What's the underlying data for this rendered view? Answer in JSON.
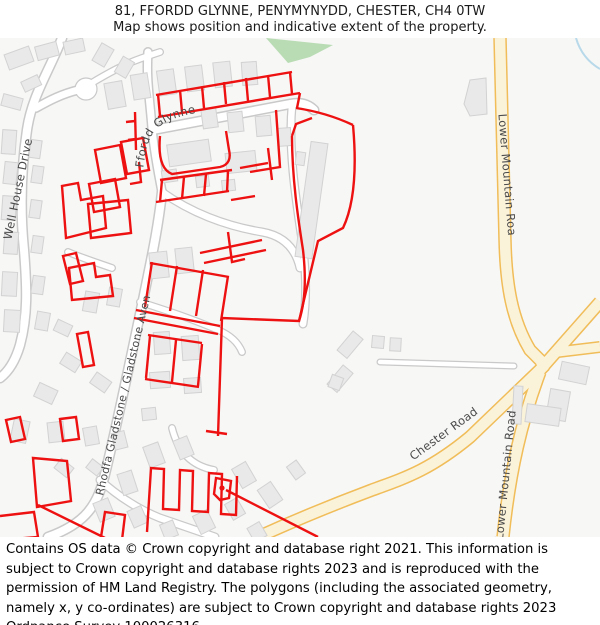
{
  "header": {
    "line1": "81, FFORDD GLYNNE, PENYMYNYDD, CHESTER, CH4 0TW",
    "line2": "Map shows position and indicative extent of the property."
  },
  "map": {
    "road_labels": {
      "well_house_drive": "Well House Drive",
      "ffordd_glynne": "Ffordd Glynne",
      "gladstone_avenue": "Rhodfa Gladstone / Gladstone Avenue",
      "lower_mountain_road_top": "Lower Mountain Road",
      "lower_mountain_road_bottom": "Lower Mountain Road",
      "chester_road": "Chester Road"
    },
    "legend": "red outline = indicative extent of the property parcels"
  },
  "footer": {
    "text": "Contains OS data © Crown copyright and database right 2021. This information is subject to Crown copyright and database rights 2023 and is reproduced with the permission of HM Land Registry. The polygons (including the associated geometry, namely x, y co-ordinates) are subject to Crown copyright and database rights 2023 Ordnance Survey 100026316."
  },
  "colors": {
    "boundary_red": "#ee1111",
    "road_yellow_casing": "#f0bd59",
    "road_yellow_fill": "#fbf2da",
    "road_white_casing": "#c9c9c9",
    "road_white_fill": "#ffffff",
    "building_fill": "#e9e9e9",
    "building_stroke": "#d2d2d2",
    "green_area": "#b9dcb4",
    "water_blue": "#b8d9e9",
    "map_background": "#f7f7f6"
  }
}
